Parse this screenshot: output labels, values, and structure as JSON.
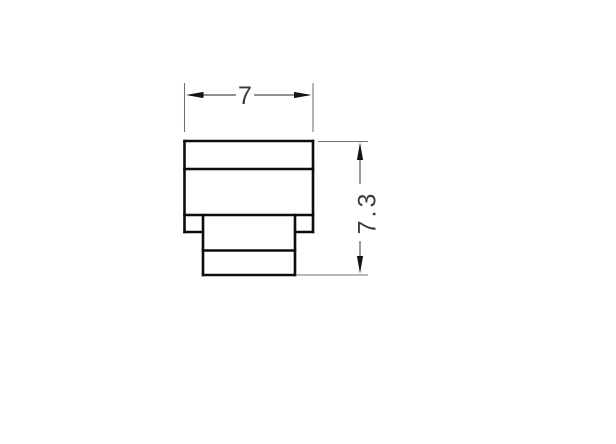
{
  "page": {
    "background_color": "#ffffff",
    "description": "Technical dimension drawing (side profile) of a stepped component"
  },
  "drawing": {
    "colors": {
      "part_outline": "#0d0d0d",
      "dimension_lines": "#4f4f4f",
      "extension_lines": "#707070",
      "arrowheads": "#141414",
      "label_text": "#3a3a3a"
    },
    "dimensions": {
      "width": {
        "value": "7",
        "orientation": "horizontal"
      },
      "height": {
        "value": "7.3",
        "orientation": "vertical"
      }
    }
  }
}
